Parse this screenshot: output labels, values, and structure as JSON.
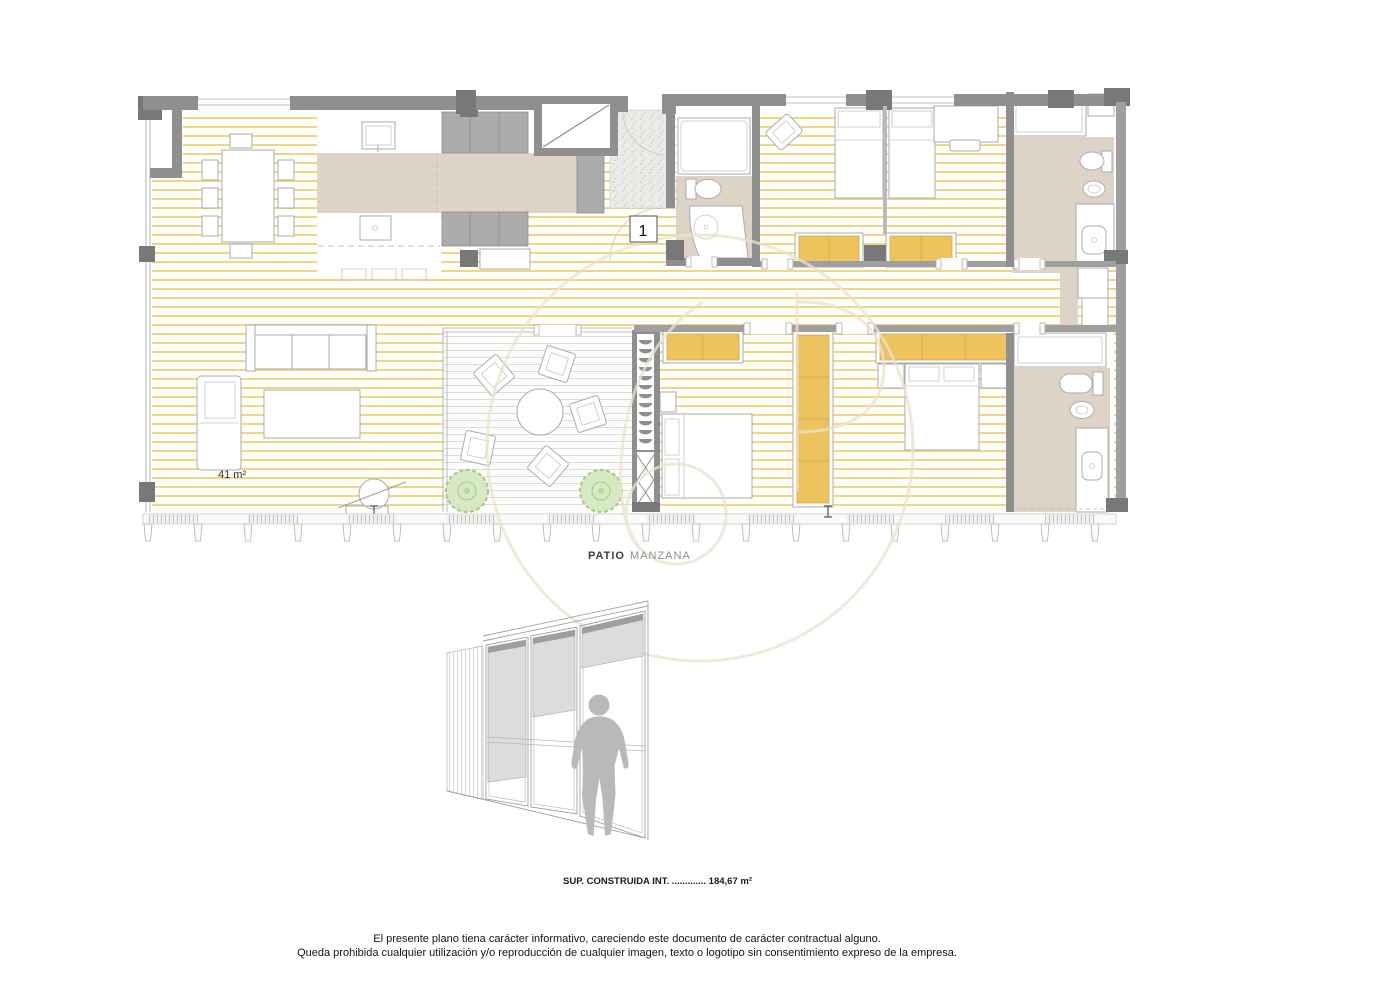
{
  "plan": {
    "room_number": "1",
    "living_area_label": "41 m²",
    "patio_word1": "PATIO",
    "patio_word2": "MANZANA"
  },
  "summary": {
    "built_area_label": "SUP. CONSTRUIDA INT. ............. 184,67 m²"
  },
  "disclaimer": {
    "line1": "El presente plano tiena carácter informativo, careciendo este documento de carácter contractual alguno.",
    "line2": "Queda prohibida cualquier utilización y/o reproducción de cualquier imagen, texto o logotipo sin consentimiento expreso de la empresa."
  },
  "colors": {
    "wall_gray": "#8f8f8f",
    "floor_stripe_yellow": "#eed787",
    "wardrobe_orange": "#edc35e",
    "surface_beige": "#ded3c7",
    "plant_green": "#d7e9c3",
    "watermark_beige": "#ece1cd"
  }
}
